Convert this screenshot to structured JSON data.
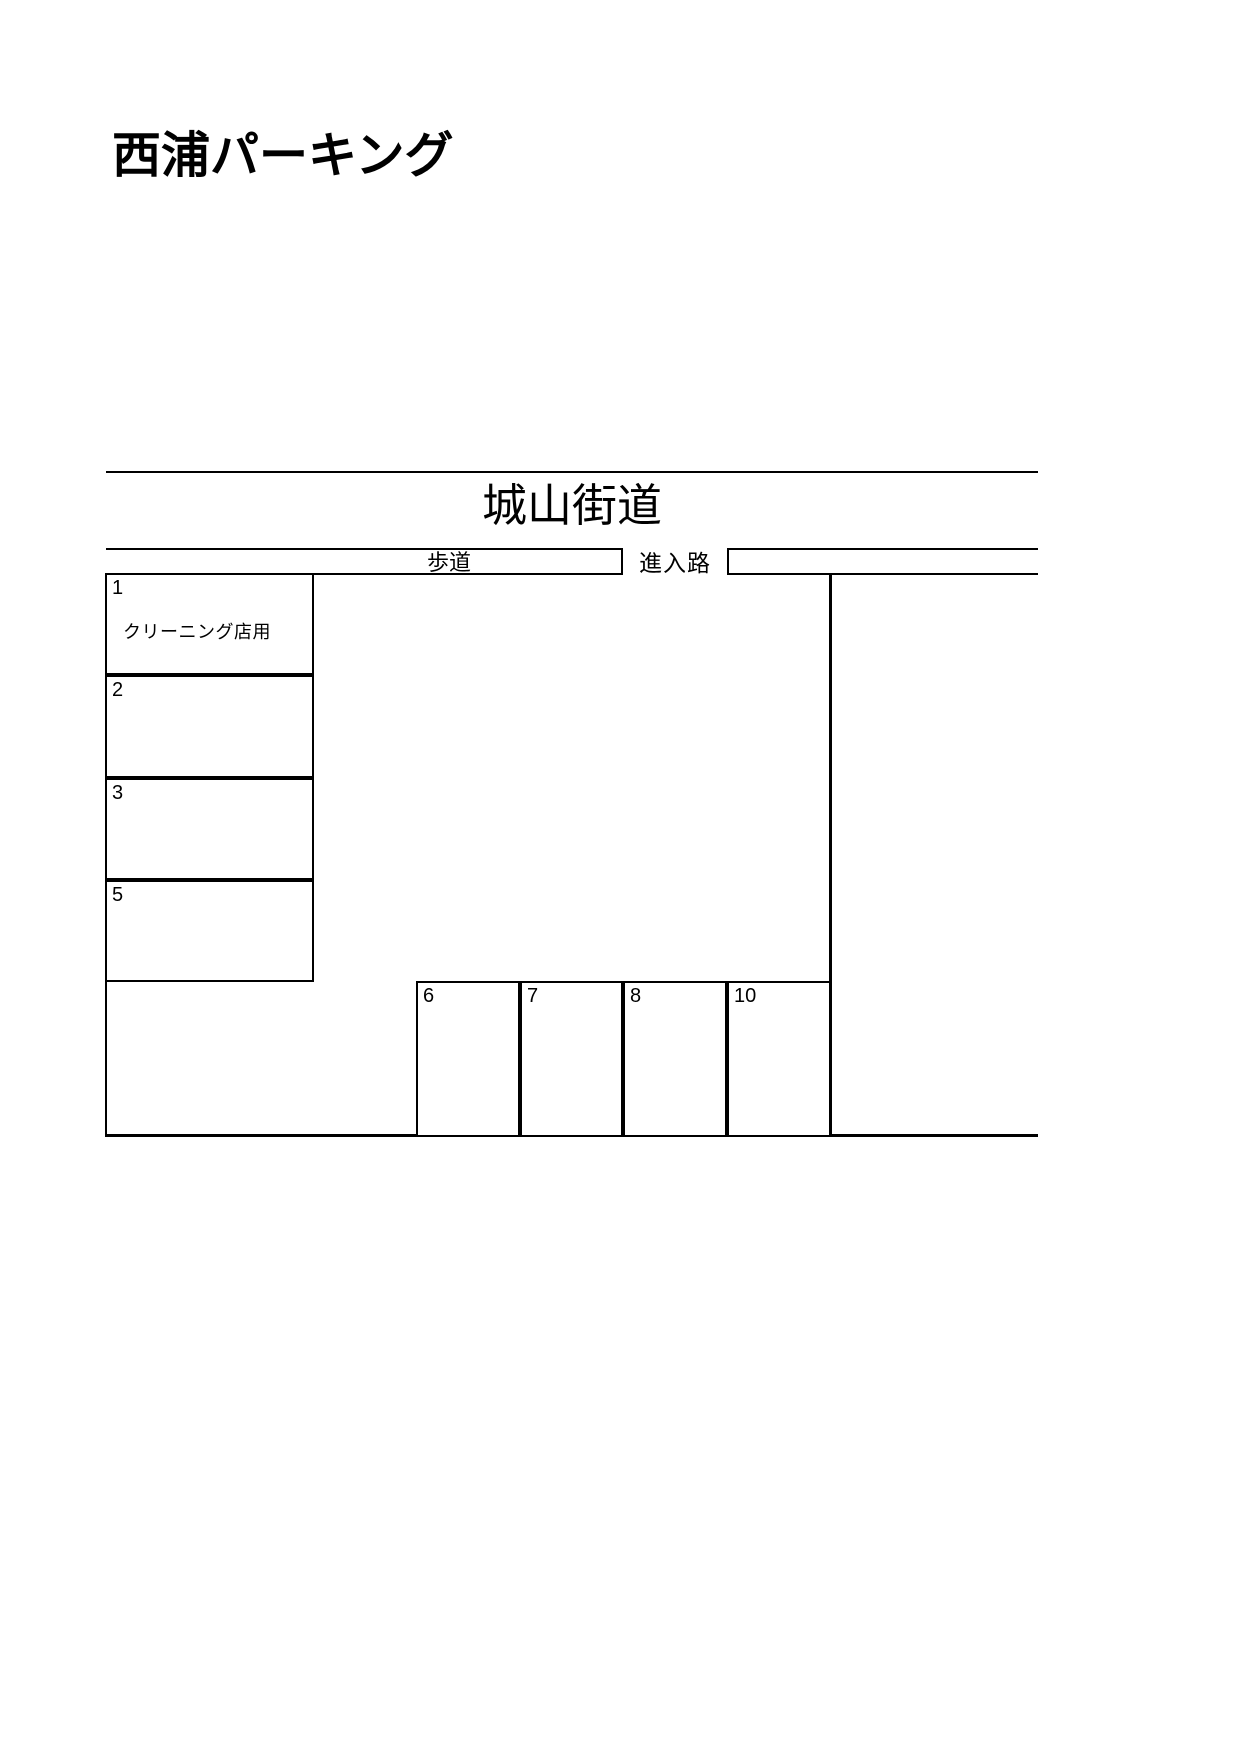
{
  "page": {
    "title": "西浦パーキング",
    "background_color": "#ffffff",
    "line_color": "#000000",
    "text_color": "#000000"
  },
  "diagram": {
    "road_name": "城山街道",
    "sidewalk_label": "歩道",
    "entrance_label": "進入路",
    "left_column_spaces": [
      {
        "number": "1",
        "note": "クリーニング店用"
      },
      {
        "number": "2",
        "note": ""
      },
      {
        "number": "3",
        "note": ""
      },
      {
        "number": "5",
        "note": ""
      }
    ],
    "bottom_row_spaces": [
      {
        "number": "6"
      },
      {
        "number": "7"
      },
      {
        "number": "8"
      },
      {
        "number": "10"
      }
    ]
  }
}
